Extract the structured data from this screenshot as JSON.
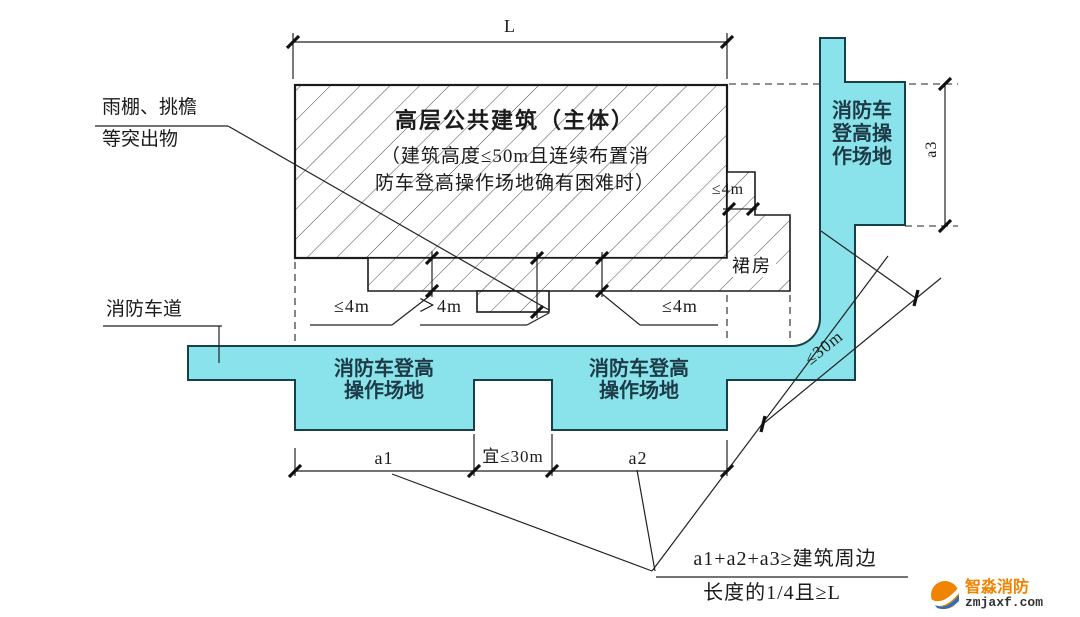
{
  "colors": {
    "site_fill": "#8ae3ea",
    "site_border": "#16404a",
    "line": "#222222",
    "hatch_line": "#4a4a4a",
    "site_text": "#1d3a47",
    "brand_orange": "#f08300",
    "brand_dark": "#333333"
  },
  "building": {
    "title": "高层公共建筑（主体）",
    "note_line1": "（建筑高度≤50m且连续布置消",
    "note_line2": "防车登高操作场地确有困难时）",
    "podium": "裙房"
  },
  "dimensions": {
    "top_length": "L",
    "side_step": "≤4m",
    "band_left": "≤4m",
    "column": "＞4m",
    "band_right": "≤4m",
    "a1": "a1",
    "gap": "宜≤30m",
    "a2": "a2",
    "a3": "a3",
    "diag": "≤30m"
  },
  "annotations": {
    "protrusion_line1": "雨棚、挑檐",
    "protrusion_line2": "等突出物",
    "fire_lane": "消防车道",
    "formula_line1": "a1+a2+a3≥建筑周边",
    "formula_line2": "长度的1/4且≥L"
  },
  "sites": {
    "left_line1": "消防车登高",
    "left_line2": "操作场地",
    "right_line1": "消防车登高",
    "right_line2": "操作场地",
    "vertical_line1": "消防车",
    "vertical_line2": "登高操",
    "vertical_line3": "作场地"
  },
  "watermark": {
    "brand": "智淼消防",
    "site": "zmjaxf.com"
  }
}
